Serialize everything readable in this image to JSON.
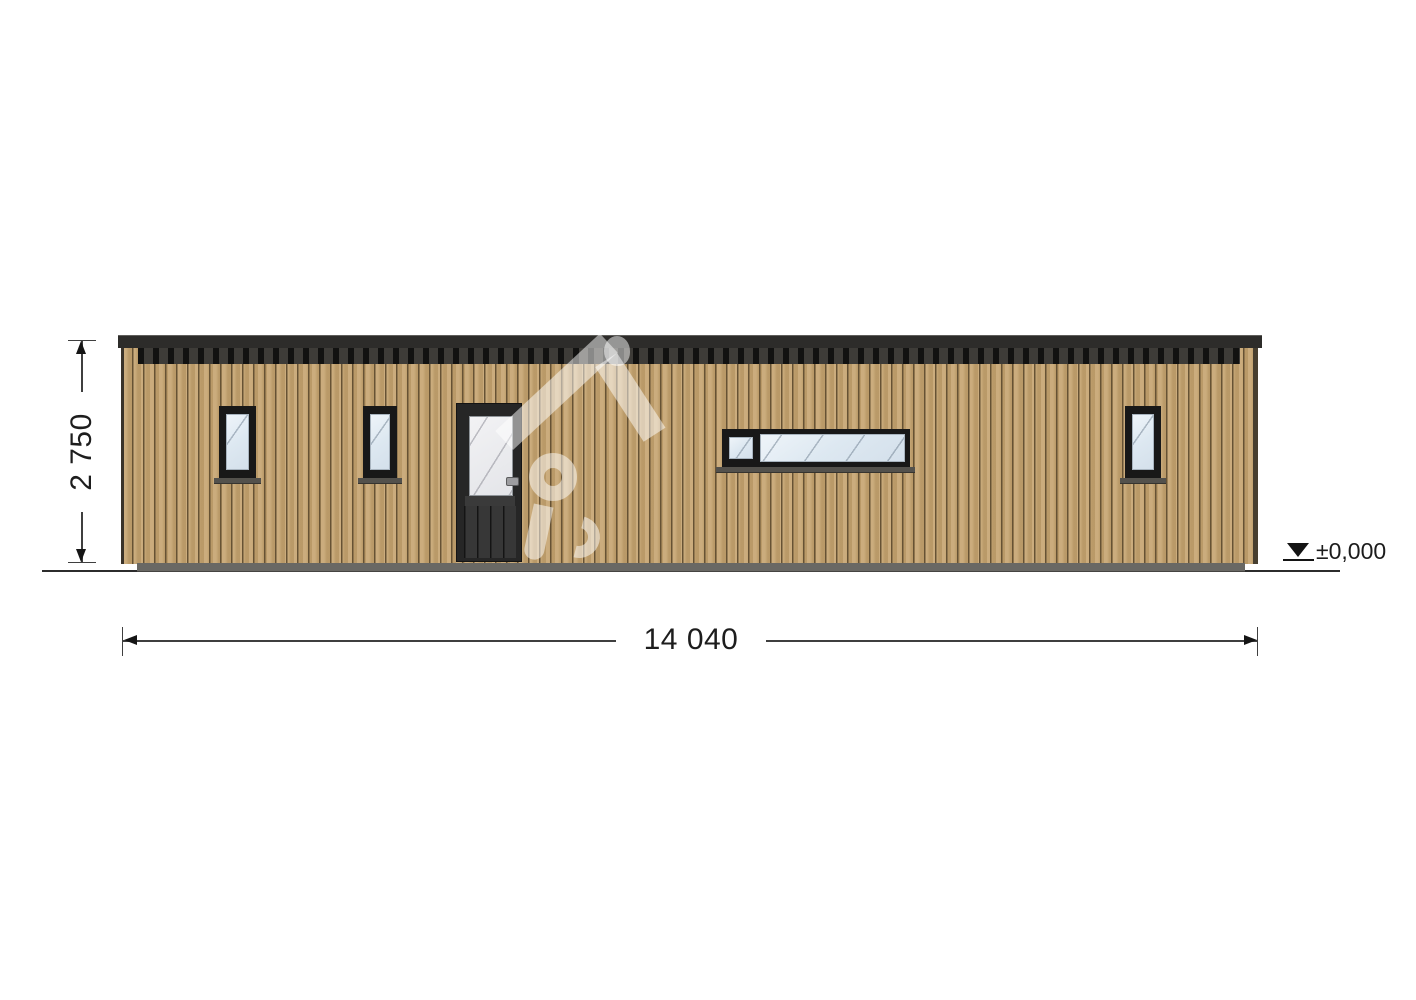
{
  "drawing": {
    "title": "Side elevation of timber-clad cabin",
    "labels": {
      "height": "2 750",
      "width": "14 040",
      "ground_level": "±0,000"
    },
    "colors": {
      "wood": "#c5a36e",
      "wood-gap": "#665234",
      "fascia": "#2d2c2a",
      "slat": "#121211",
      "slat-gap": "#3e3c38",
      "frame": "#181818",
      "glass-light": "#eef4f9",
      "glass-dark": "#d4e0eb",
      "sill": "#53514c",
      "plinth": "#696864",
      "ground": "#2c2c2c",
      "dim-line": "#3f3f3f",
      "text": "#1d1d1d"
    }
  }
}
